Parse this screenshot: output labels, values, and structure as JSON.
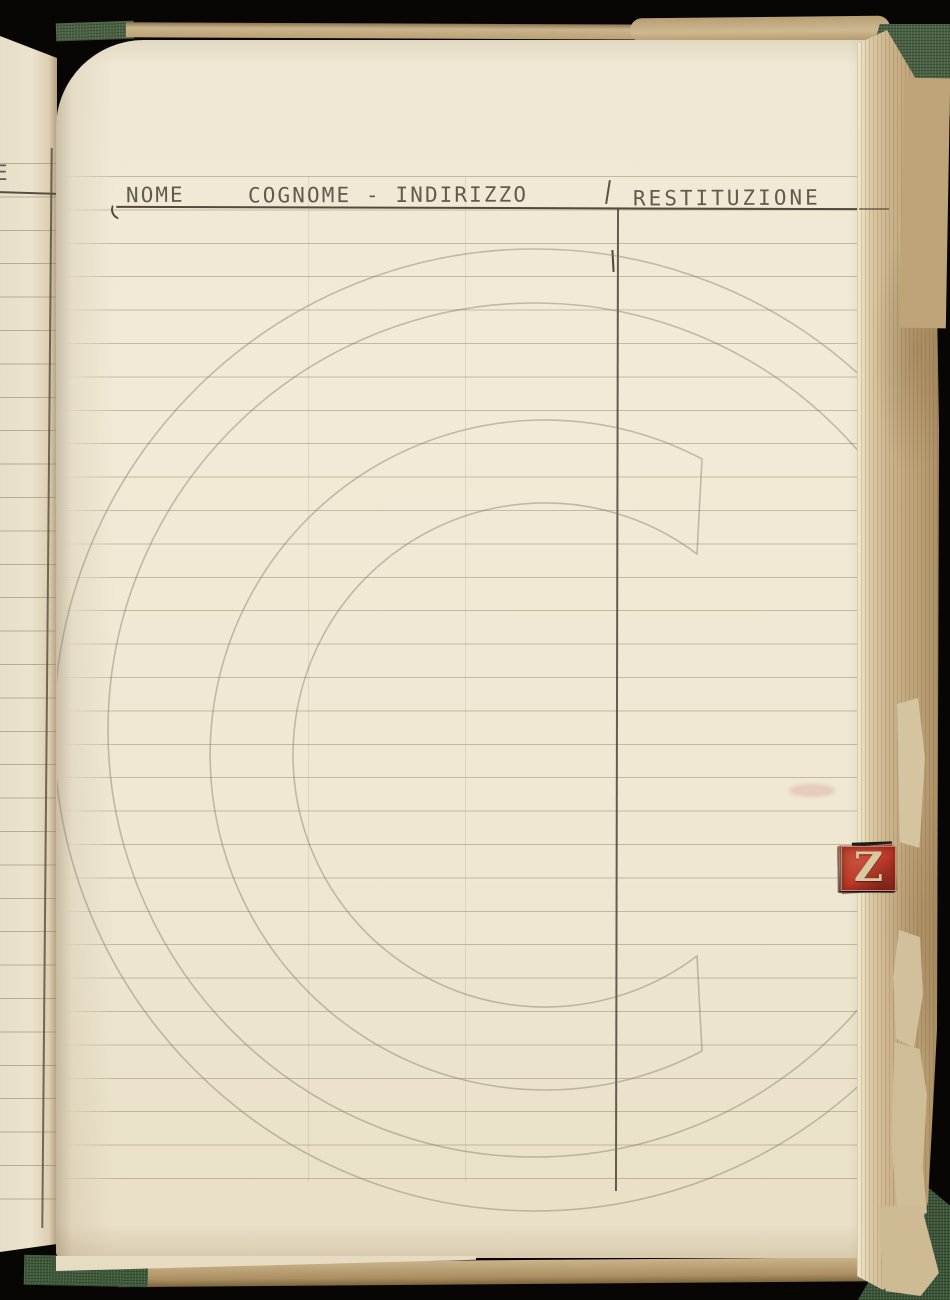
{
  "ledger_page": {
    "column_headers": {
      "name": "NOME",
      "surname_address": "COGNOME - INDIRIZZO",
      "return": "RESTITUZIONE"
    },
    "divider_tick": "'",
    "adjacent_page_fragment": "E",
    "entries": [],
    "watermark_glyph": "C"
  },
  "index_tabs": {
    "letters": [
      {
        "letter": "R",
        "color": "red"
      },
      {
        "letter": "S",
        "color": "black"
      },
      {
        "letter": "T",
        "color": "red"
      },
      {
        "letter": "U",
        "color": "black"
      },
      {
        "letter": "V",
        "color": "red"
      },
      {
        "letter": "W",
        "color": "black"
      },
      {
        "letter": "X",
        "color": "red"
      },
      {
        "letter": "Y",
        "color": "black"
      },
      {
        "letter": "Z",
        "color": "red"
      }
    ]
  },
  "colors": {
    "background": "#070605",
    "page_cream": "#f0e9d5",
    "ruled_line": "#948a70",
    "pencil": "#4e473d",
    "tab_red": "#bd3828",
    "tab_black": "#23201d",
    "tab_letter": "#d9c9a2",
    "binding_green": "#4a6243",
    "page_edge_tan": "#c9b48c",
    "watermark": "#7d7463"
  }
}
